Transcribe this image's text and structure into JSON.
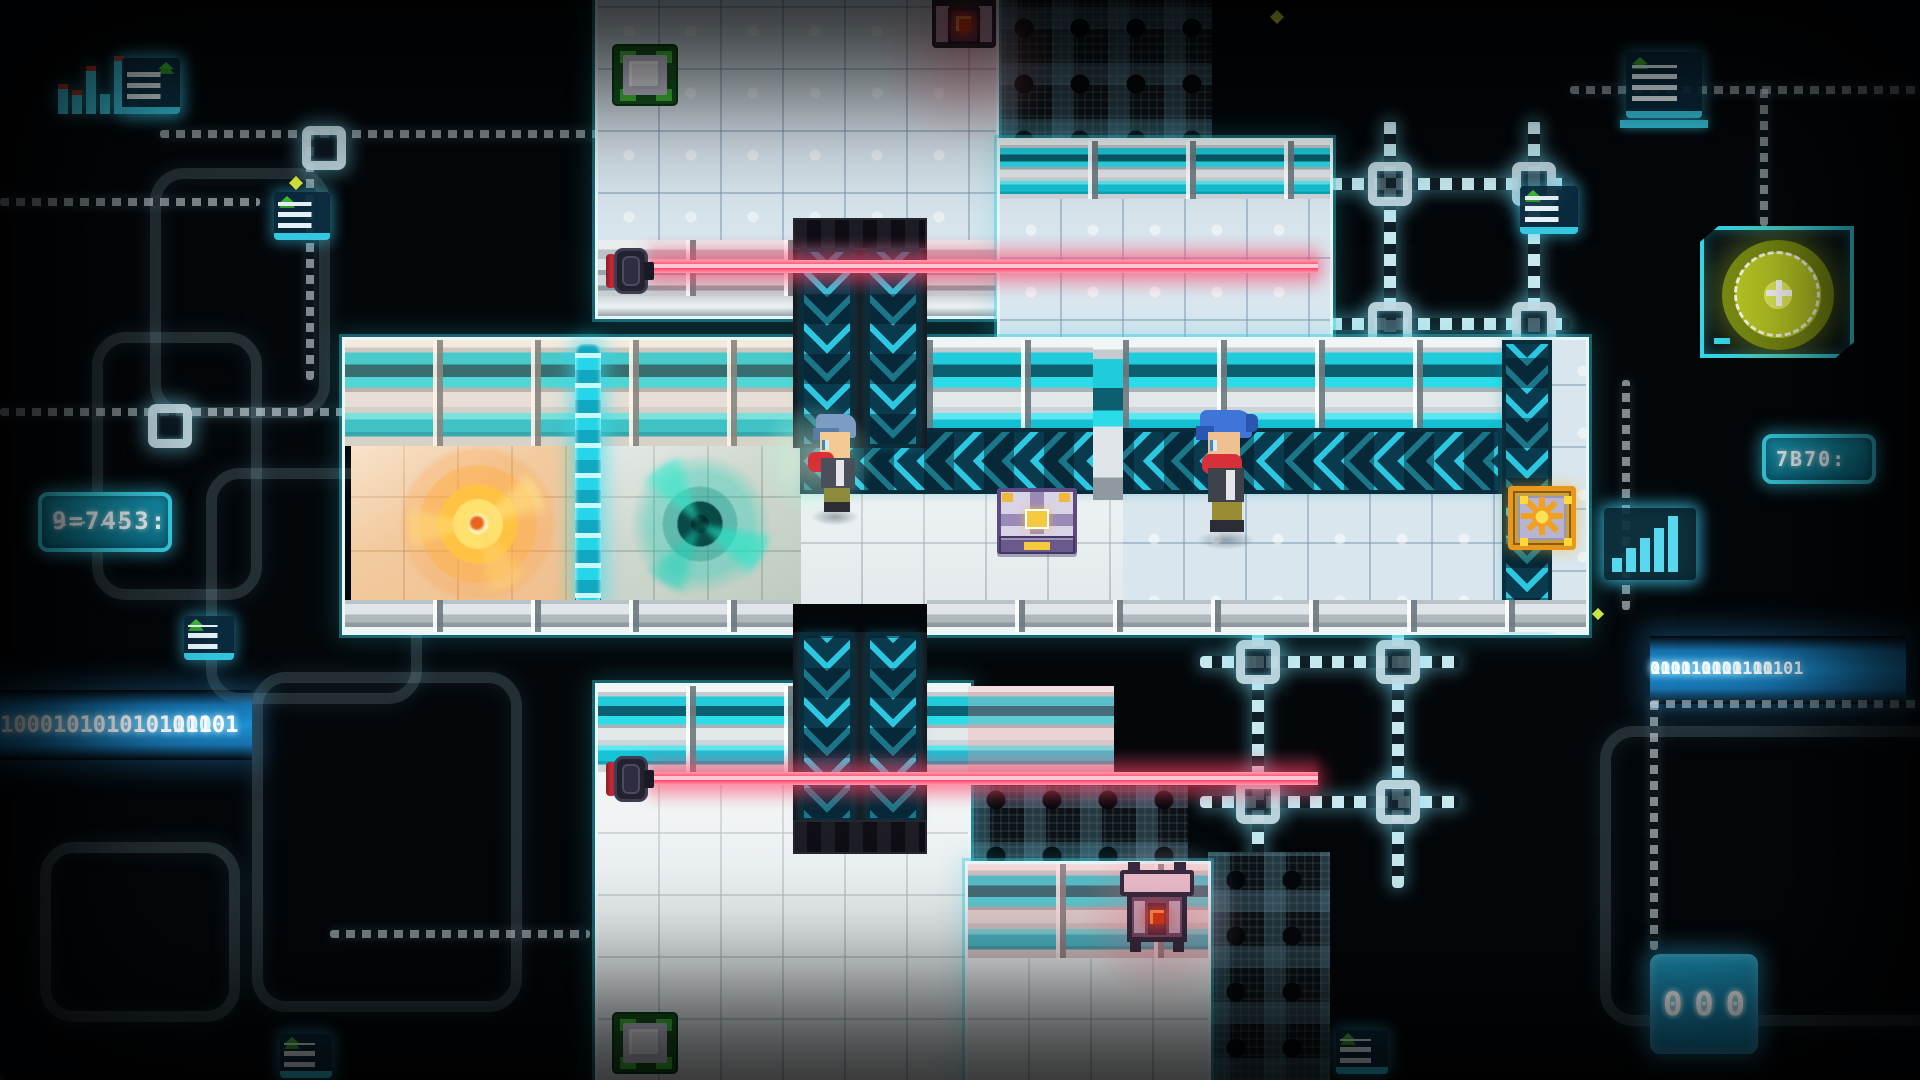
{
  "readouts": {
    "binary_left_rows": [
      "100010101010110001",
      "100010101010101101"
    ],
    "binary_right_rows": [
      "010111010101101",
      "1010110101101",
      "010110101"
    ],
    "lcd_left_value": "9=7453:",
    "lcd_left_row2": "-..-...-.",
    "lcd_right_value": "7B70:",
    "ram_chip_rows": [
      "000",
      "000"
    ]
  },
  "palette": {
    "background": "#05080b",
    "circuit_glow": "#9fdcec",
    "conveyor_teal": "#2cc8e2",
    "conveyor_dark": "#0b4156",
    "laser_pink": "#ff4f72",
    "portal_orange": "#ffb23a",
    "portal_teal": "#17e0c2",
    "floor_white": "#e8eef0",
    "floor_blue": "#d9e6ee",
    "wall_teal_stripe": "#2adce8",
    "device_core_red": "#e03818",
    "plate_green": "#44c438",
    "gold": "#f2c43c",
    "chest_purple": "#5c4a80",
    "hair_blue_left": "#7d9cc4",
    "hair_blue_right": "#3f74d8",
    "scarf_red": "#d83038"
  },
  "entities": [
    {
      "name": "laser-emitter-top"
    },
    {
      "name": "laser-beam-top"
    },
    {
      "name": "laser-emitter-bottom"
    },
    {
      "name": "laser-beam-bottom"
    },
    {
      "name": "portal-orange"
    },
    {
      "name": "portal-teal"
    },
    {
      "name": "diamond-fence"
    },
    {
      "name": "conveyor-horizontal"
    },
    {
      "name": "conveyor-column-top"
    },
    {
      "name": "conveyor-column-bottom"
    },
    {
      "name": "conveyor-column-right"
    },
    {
      "name": "character-left"
    },
    {
      "name": "character-right"
    },
    {
      "name": "power-core-chest"
    },
    {
      "name": "sun-tile"
    },
    {
      "name": "pressure-plate-top"
    },
    {
      "name": "pressure-plate-bottom"
    },
    {
      "name": "security-device-top"
    },
    {
      "name": "security-device-bottom"
    }
  ],
  "background_icons": [
    "bar-chart-icon",
    "document-icon",
    "lcd-display",
    "binary-readout",
    "virus-scan-icon",
    "memory-chip-icon",
    "sparkle-icon"
  ]
}
